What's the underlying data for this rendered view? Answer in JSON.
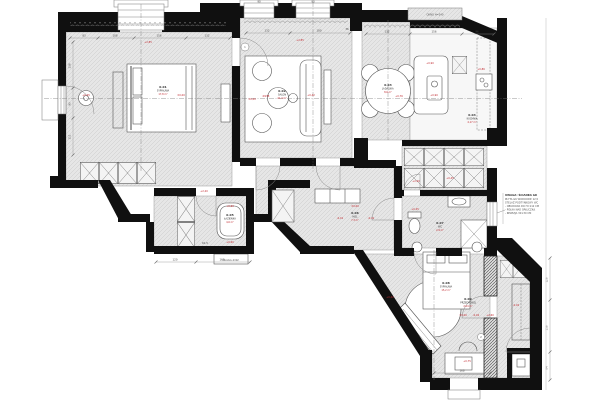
{
  "drawing": {
    "top_note": "OKNO H=240",
    "pralnia_label": "PRALKA+SUSZ.",
    "side_note": {
      "title": "UWAGA: ŚCIANKA GK",
      "lines": [
        "PŁYTA GK WODOODP. 12,5",
        "STELAŻ PODTYNKOWY WC",
        "- OBUDOWA DO H=112 CM",
        "- PÓŁKA NAD SPŁUCZKĄ",
        "- REWIZJA 30×30 CM"
      ]
    }
  },
  "rooms": [
    {
      "id": "0.01",
      "name": "SYPIALNIA",
      "area": "17,8 m²"
    },
    {
      "id": "0.02",
      "name": "SALON",
      "area": "21,4 m²"
    },
    {
      "id": "0.03",
      "name": "JADALNIA",
      "area": "8,6 m²"
    },
    {
      "id": "0.04",
      "name": "KUCHNIA",
      "area": "4,17 m²"
    },
    {
      "id": "0.05",
      "name": "ŁAZIENKA",
      "area": "4,6 m²"
    },
    {
      "id": "0.06",
      "name": "HOL",
      "area": "7,3 m²"
    },
    {
      "id": "0.07",
      "name": "WC",
      "area": "2,9 m²"
    },
    {
      "id": "0.08",
      "name": "SYPIALNIA",
      "area": "15,2 m²"
    },
    {
      "id": "0.09",
      "name": "PRZEDPOKÓJ",
      "area": "2,04 m²"
    }
  ],
  "marks": [
    "+2,85",
    "+0,45",
    "±0,00",
    "±0,00",
    "+2,85",
    "Ø138",
    "+0,42",
    "+0,76",
    "+0,90",
    "+0,90",
    "+0,86",
    "-0,01",
    "±0,00",
    "-0,01",
    "+0,60",
    "+0,60",
    "+2,20",
    "+2,20",
    "+0,45",
    "+0,45",
    "±0,00",
    "-0,02",
    "+2,60",
    "-0,02",
    "+0,42",
    "+0,75"
  ],
  "dims": [
    "83",
    "108",
    "156",
    "132",
    "138",
    "90",
    "111",
    "132",
    "180",
    "132",
    "156",
    "96",
    "120",
    "162",
    "126",
    "156",
    "84",
    "168",
    "90",
    "90",
    "36",
    "61,5"
  ],
  "refs": [
    "1",
    "2"
  ]
}
